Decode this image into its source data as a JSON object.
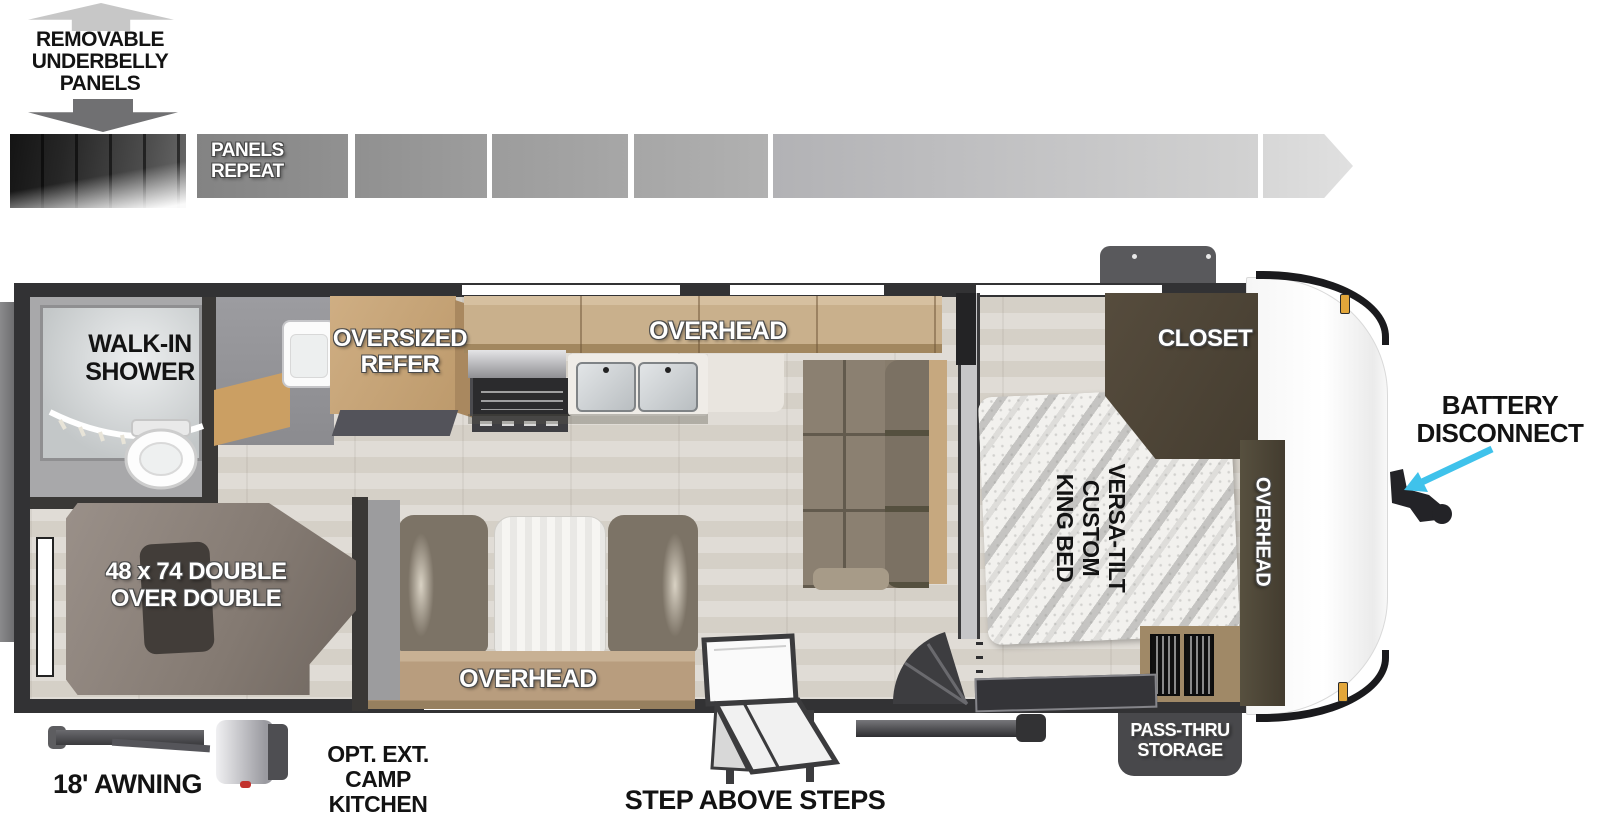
{
  "underbelly": {
    "line1": "REMOVABLE",
    "line2": "UNDERBELLY",
    "line3": "PANELS",
    "strip_line1": "PANELS",
    "strip_line2": "REPEAT"
  },
  "interior_labels": {
    "shower_line1": "WALK-IN",
    "shower_line2": "SHOWER",
    "refer_line1": "OVERSIZED",
    "refer_line2": "REFER",
    "overhead_kitchen": "OVERHEAD",
    "closet": "CLOSET",
    "bed_line1": "VERSA-TILT",
    "bed_line2": "CUSTOM",
    "bed_line3": "KING BED",
    "overhead_front": "OVERHEAD",
    "bunk_line1": "48 x 74 DOUBLE",
    "bunk_line2": "OVER DOUBLE",
    "overhead_dinette": "OVERHEAD",
    "passthru_line1": "PASS-THRU",
    "passthru_line2": "STORAGE"
  },
  "exterior_labels": {
    "battery_line1": "BATTERY",
    "battery_line2": "DISCONNECT",
    "awning": "18' AWNING",
    "camp_line1": "OPT. EXT.",
    "camp_line2": "CAMP",
    "camp_line3": "KITCHEN",
    "steps": "STEP ABOVE STEPS"
  },
  "colors": {
    "callout_arrow": "#3fc2eb",
    "marker_light": "#e2a63a",
    "wall": "#323234",
    "wood_cabinet": "#c7a477",
    "dark_cabinet": "#4e4639"
  }
}
